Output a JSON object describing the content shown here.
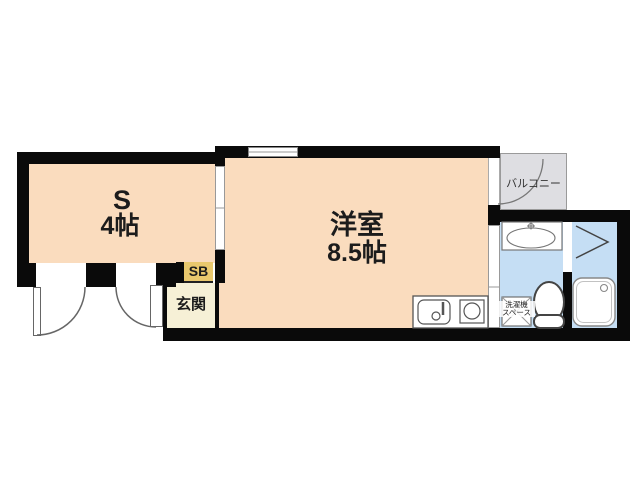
{
  "plan": {
    "rooms": {
      "storage": {
        "name_label": "S",
        "size_label": "4帖"
      },
      "western": {
        "name_label": "洋室",
        "size_label": "8.5帖"
      },
      "balcony": {
        "label": "バルコニー"
      },
      "entrance": {
        "label": "玄関"
      },
      "shoebox": {
        "label": "SB"
      },
      "laundry": {
        "line1": "洗濯機",
        "line2": "スペース"
      }
    },
    "colors": {
      "room_fill": "#FADCBE",
      "wet_area_fill": "#C5DEF4",
      "balcony_fill": "#DEDEE2",
      "entrance_fill": "#F6F0D6",
      "shoebox_fill": "#E9C86D",
      "wall": "#0A0A0A"
    }
  }
}
